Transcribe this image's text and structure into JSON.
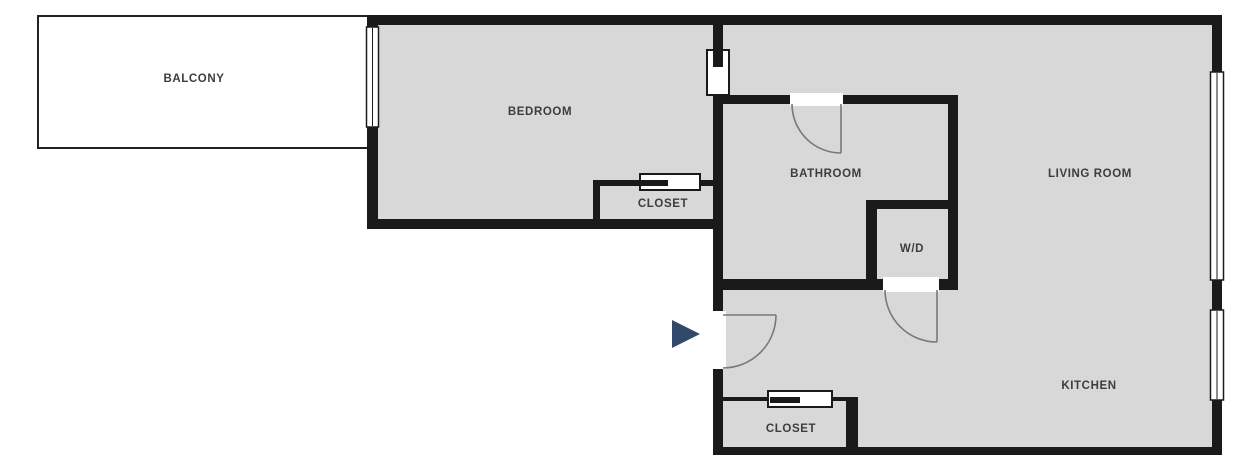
{
  "plan": {
    "labels": {
      "balcony": "BALCONY",
      "bedroom": "BEDROOM",
      "bedroom_closet": "CLOSET",
      "bathroom": "BATHROOM",
      "wd": "W/D",
      "living_room": "LIVING ROOM",
      "kitchen": "KITCHEN",
      "entry_closet": "CLOSET"
    },
    "colors": {
      "floor": "#d8d8d8",
      "wall": "#1a1a1a",
      "balcony_fill": "#ffffff",
      "door_swing": "#787878",
      "entry_arrow": "#31496b",
      "label_text": "#3d3d3d"
    }
  }
}
